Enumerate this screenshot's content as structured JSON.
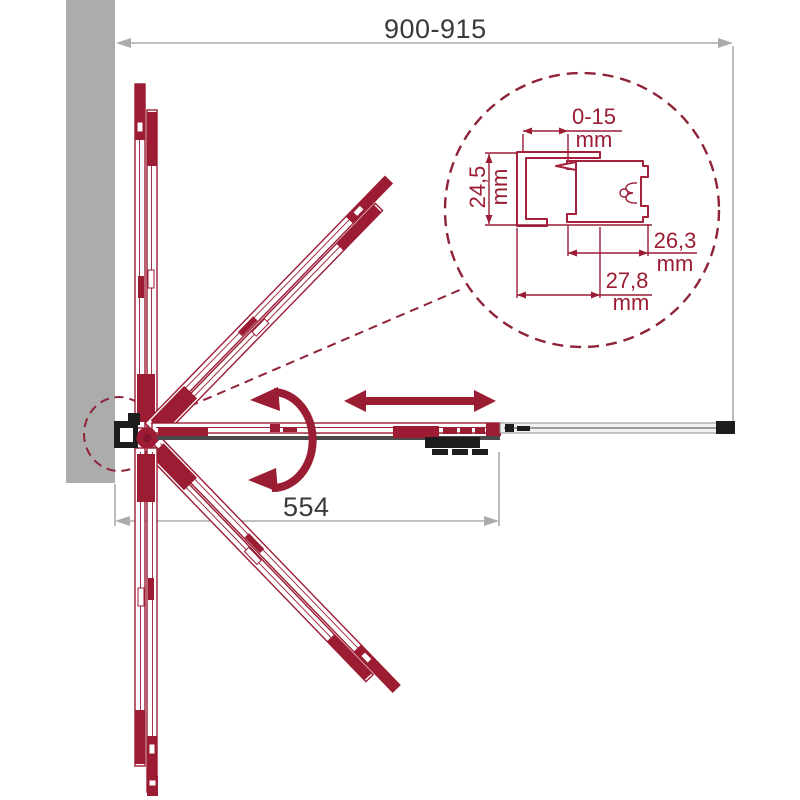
{
  "colors": {
    "maroon": "#9B1C33",
    "dim_line_gray": "#ABABAB",
    "text_dark": "#3A3A3A",
    "wall_gray": "#ACACAC",
    "black_parts": "#1D1D1D"
  },
  "dimensions": {
    "overall_width": "900-915",
    "door_panel_width": "554"
  },
  "detail_view": {
    "top_gap": {
      "value": "0-15",
      "unit": "mm"
    },
    "profile_depth": {
      "value": "24,5",
      "unit": "mm"
    },
    "door_profile_width": {
      "value": "26,3",
      "unit": "mm"
    },
    "wall_profile_width": {
      "value": "27,8",
      "unit": "mm"
    }
  },
  "icons": {
    "slide": "double-headed-slide-arrow",
    "rotate": "curved-fold-rotation-arrow",
    "detail": "detail-zoom-dashed-circle"
  }
}
